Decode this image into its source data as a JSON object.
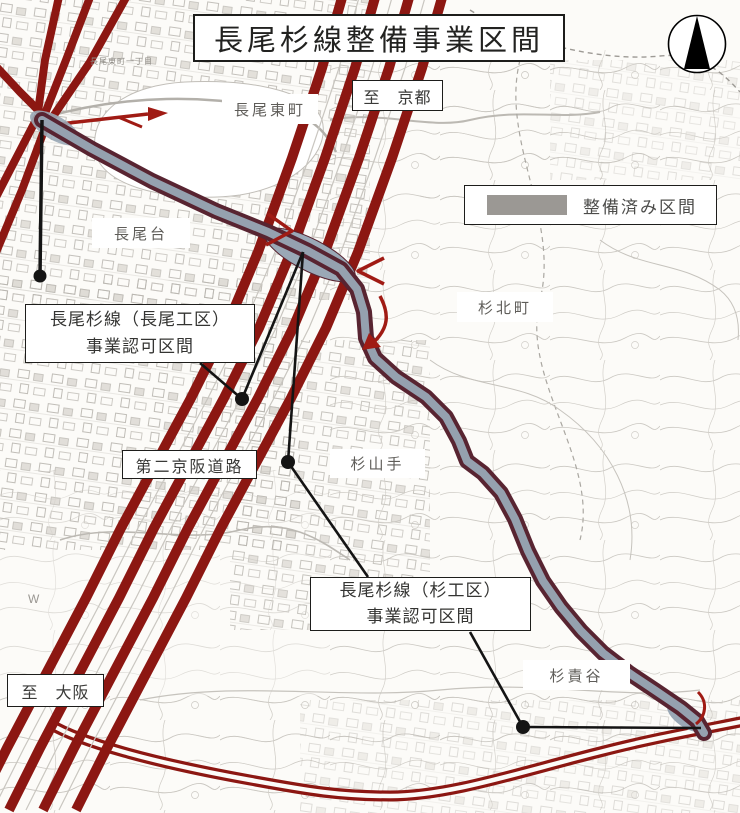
{
  "title": "長尾杉線整備事業区間",
  "legend": {
    "label": "整備済み区間",
    "swatch_color": "#9b9894"
  },
  "directions": {
    "kyoto": "至　京都",
    "osaka": "至　大阪"
  },
  "roads": {
    "daini_keihan": "第二京阪道路"
  },
  "places": {
    "nagao_higashimachi": "長尾東町",
    "nagaodai": "長尾台",
    "sugikitamachi": "杉北町",
    "sugiyamate": "杉山手",
    "sugisekidani": "杉責谷"
  },
  "small_labels": {
    "chome": "長尾東町一丁目",
    "w_mark": "W"
  },
  "callouts": {
    "nagao_koku": {
      "line1": "長尾杉線（長尾工区）",
      "line2": "事業認可区間"
    },
    "sugi_koku": {
      "line1": "長尾杉線（杉工区）",
      "line2": "事業認可区間"
    }
  },
  "colors": {
    "highway_red": "#8c1712",
    "project_road_casing": "#582431",
    "project_road_fill": "#95a1af",
    "completed_gray": "#9b9894",
    "leader_black": "#141414"
  },
  "compass": {
    "icon": "north-arrow"
  }
}
